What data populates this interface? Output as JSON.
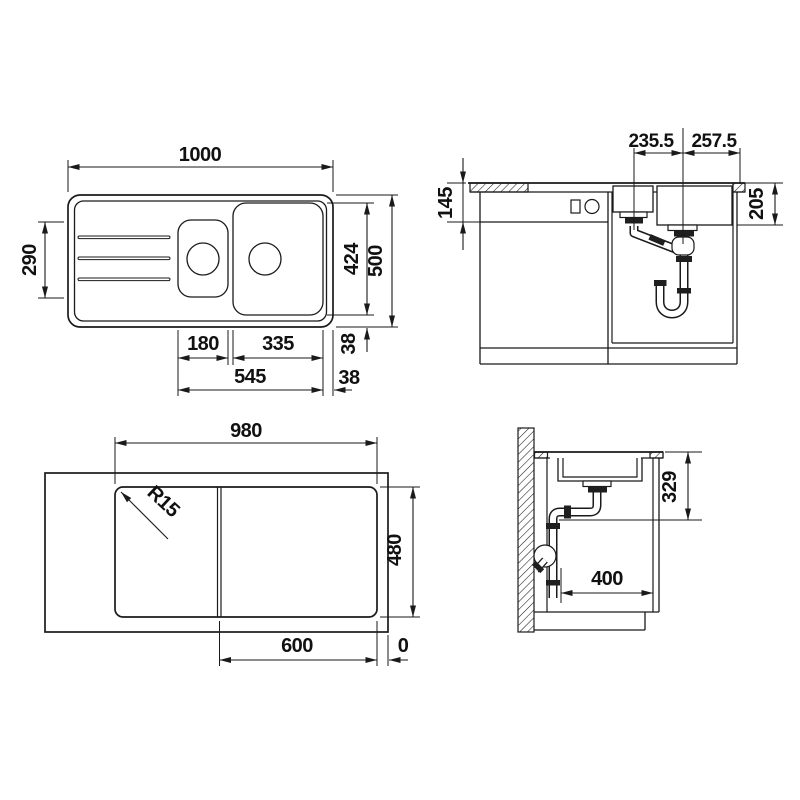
{
  "drawing": {
    "title": "sink-technical-drawing",
    "background": "#ffffff",
    "line_color": "#1a1a1a",
    "views": {
      "plan_top": {
        "label": "top-view-of-sink",
        "dims": {
          "overall_width": "1000",
          "drainboard_depth": "290",
          "bowl_zone_height": "424",
          "overall_depth": "500",
          "small_bowl_width": "180",
          "main_bowl_width": "335",
          "bowls_span": "545",
          "rim_gap_vertical": "38",
          "rim_gap_horizontal": "38"
        }
      },
      "front_elevation": {
        "label": "front-section-with-drains",
        "dims": {
          "small_drain_offset": "235.5",
          "main_drain_offset": "257.5",
          "apron_height": "145",
          "bowl_depth": "205"
        }
      },
      "cutout_plan": {
        "label": "worktop-cutout-view",
        "dims": {
          "cutout_width": "980",
          "corner_radius": "R15",
          "cutout_depth": "480",
          "cabinet_width": "600",
          "edge_offset": "0"
        }
      },
      "side_section": {
        "label": "side-section-with-trap",
        "dims": {
          "drain_depth": "329",
          "clearance_depth": "400"
        }
      }
    }
  }
}
